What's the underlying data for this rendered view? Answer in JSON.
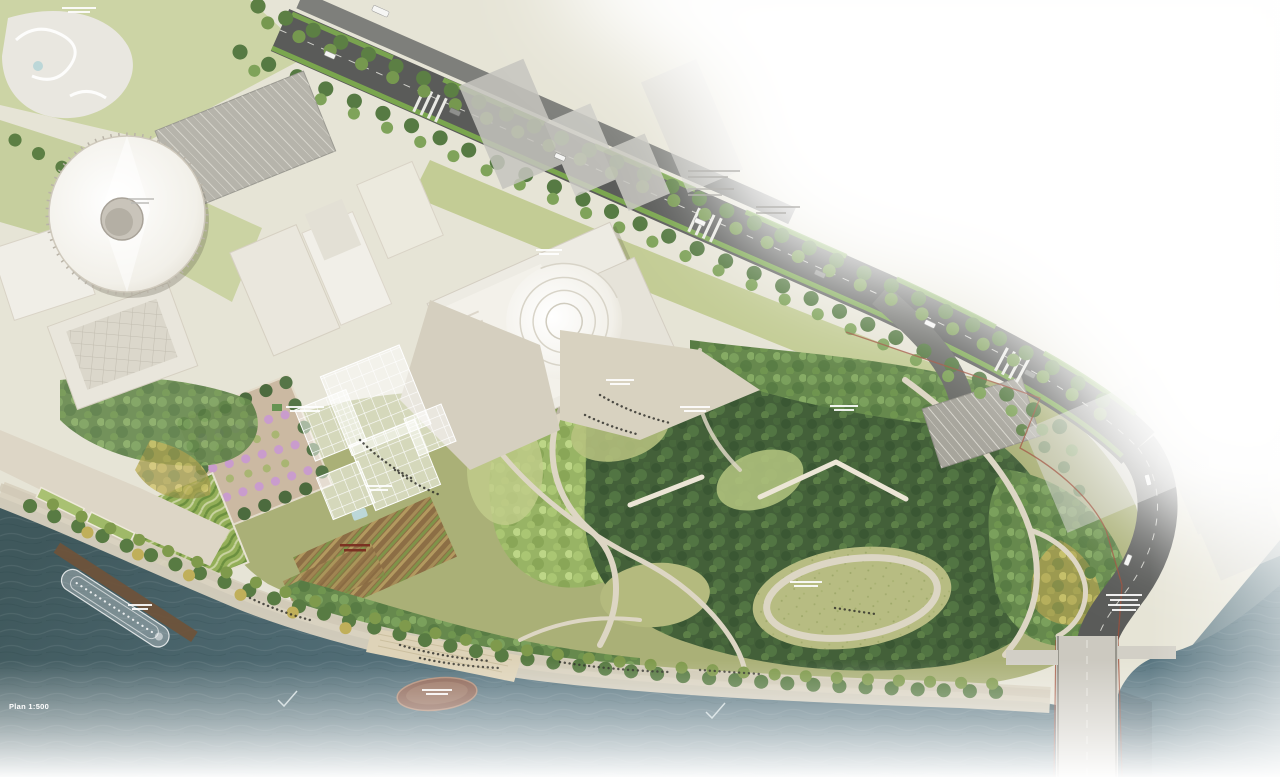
{
  "page": {
    "scale_label": "Plan 1:500"
  },
  "map": {
    "description": "Aerial masterplan rendering of a riverside urban park at 1:500 scale, river along the lower-left edge, city blocks upper-left, image fading to white toward the upper-right and bottom",
    "colors": {
      "water": "#4c686d",
      "forest_canopy": "#436039",
      "lawn": "#a9b077",
      "road_asphalt": "#5a5b59",
      "bike_lane_green": "#7cab4e",
      "quay_paving": "#d8d1bf",
      "building_roof": "#edebe3",
      "site_boundary_line": "#9e4f3b",
      "pier_wood": "#6f523a",
      "terrace_garden": "#8a6b42"
    },
    "features": [
      "round-roof concert building",
      "philharmonic hall with fan amphitheater roof",
      "glass-grid canopy pavilions",
      "flowering orchard garden",
      "hedge maze garden",
      "terraced planting stripes",
      "birch grove",
      "forest hills with winding paths",
      "great lawn ovals with loop path",
      "embankment promenade with tree rows",
      "river beach steps with crowd",
      "docked river cruise ship at wooden pier",
      "floating stage platform in river",
      "road bridge crossing the river (bottom right)",
      "tree-lined boulevard with green bike lanes and crosswalks",
      "parking lots",
      "playground with wavy paths (top left)"
    ],
    "micro_labels": {
      "count": 14,
      "note": "tiny zone captions on the plan, too small to be legible at this resolution"
    }
  }
}
